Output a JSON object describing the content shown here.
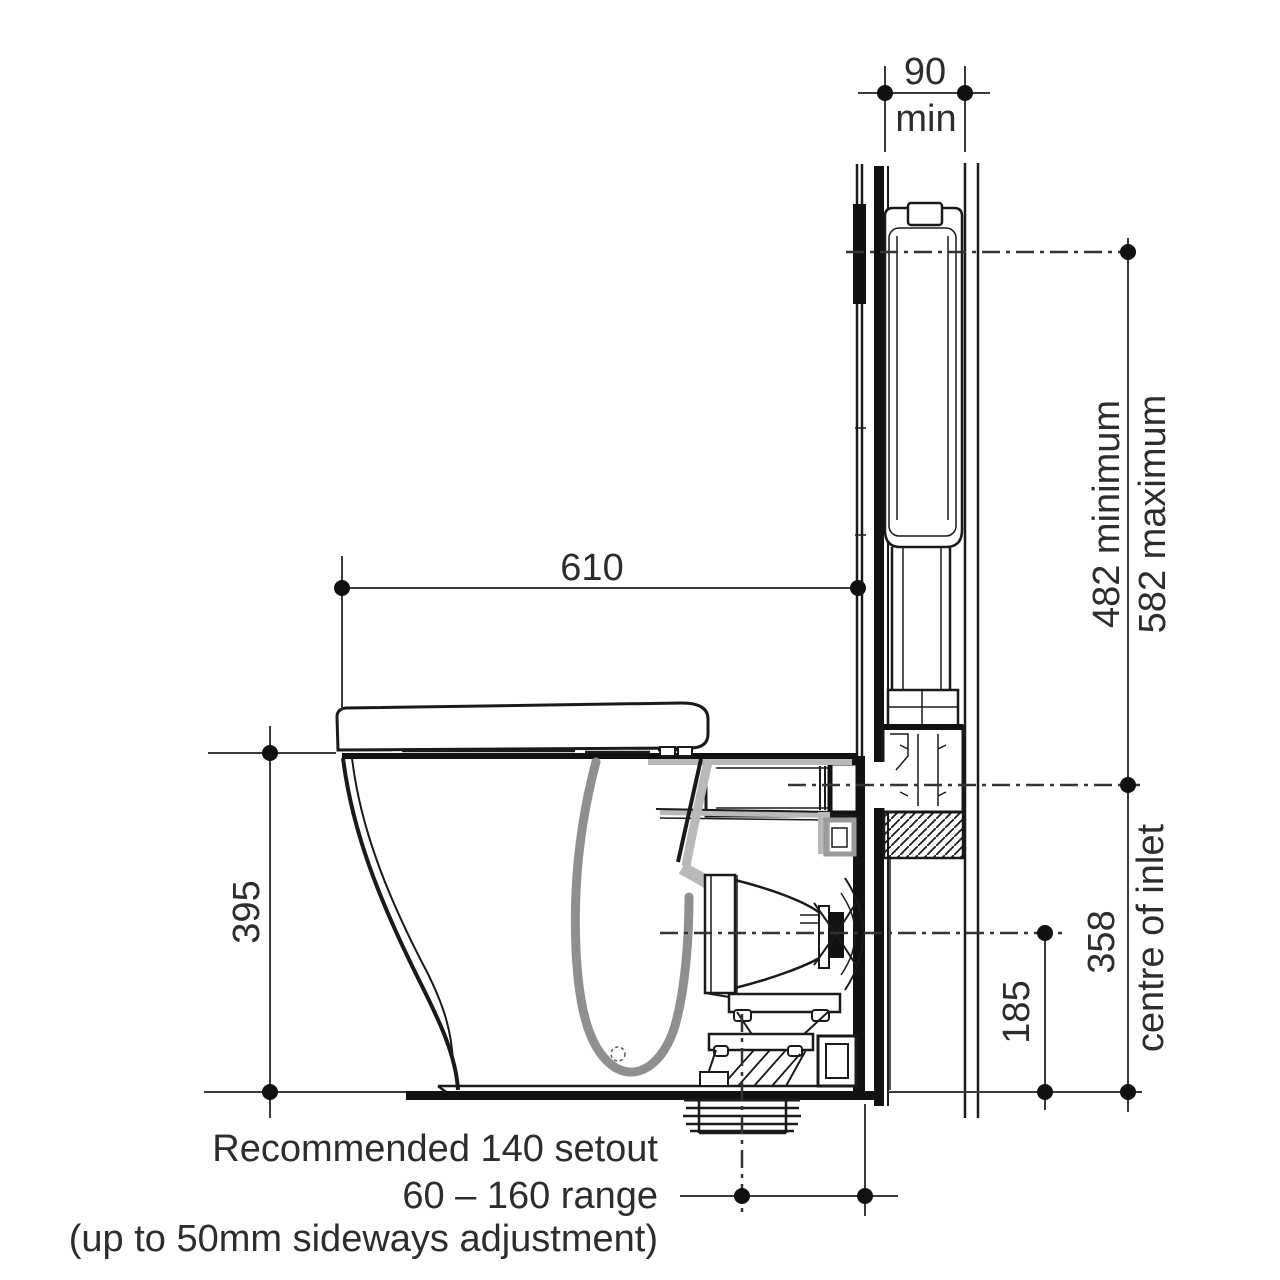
{
  "dims": {
    "cavity": {
      "value": "90",
      "qualifier": "min"
    },
    "projection": "610",
    "height": "395",
    "inlet_min": "482 minimum",
    "inlet_max": "582 maximum",
    "inlet_centre": "358",
    "inlet_centre_label": "centre of inlet",
    "outlet_centre": "185"
  },
  "notes": {
    "line1": "Recommended 140 setout",
    "line2": "60 – 160 range",
    "line3": "(up to 50mm sideways adjustment)"
  },
  "colors": {
    "line": "#1a1a1a",
    "dimension": "#3a3a3a",
    "shade": "#b9b9b9",
    "bowl_shade": "#8f8f8f",
    "text": "#2d2d2d",
    "background": "#ffffff"
  }
}
